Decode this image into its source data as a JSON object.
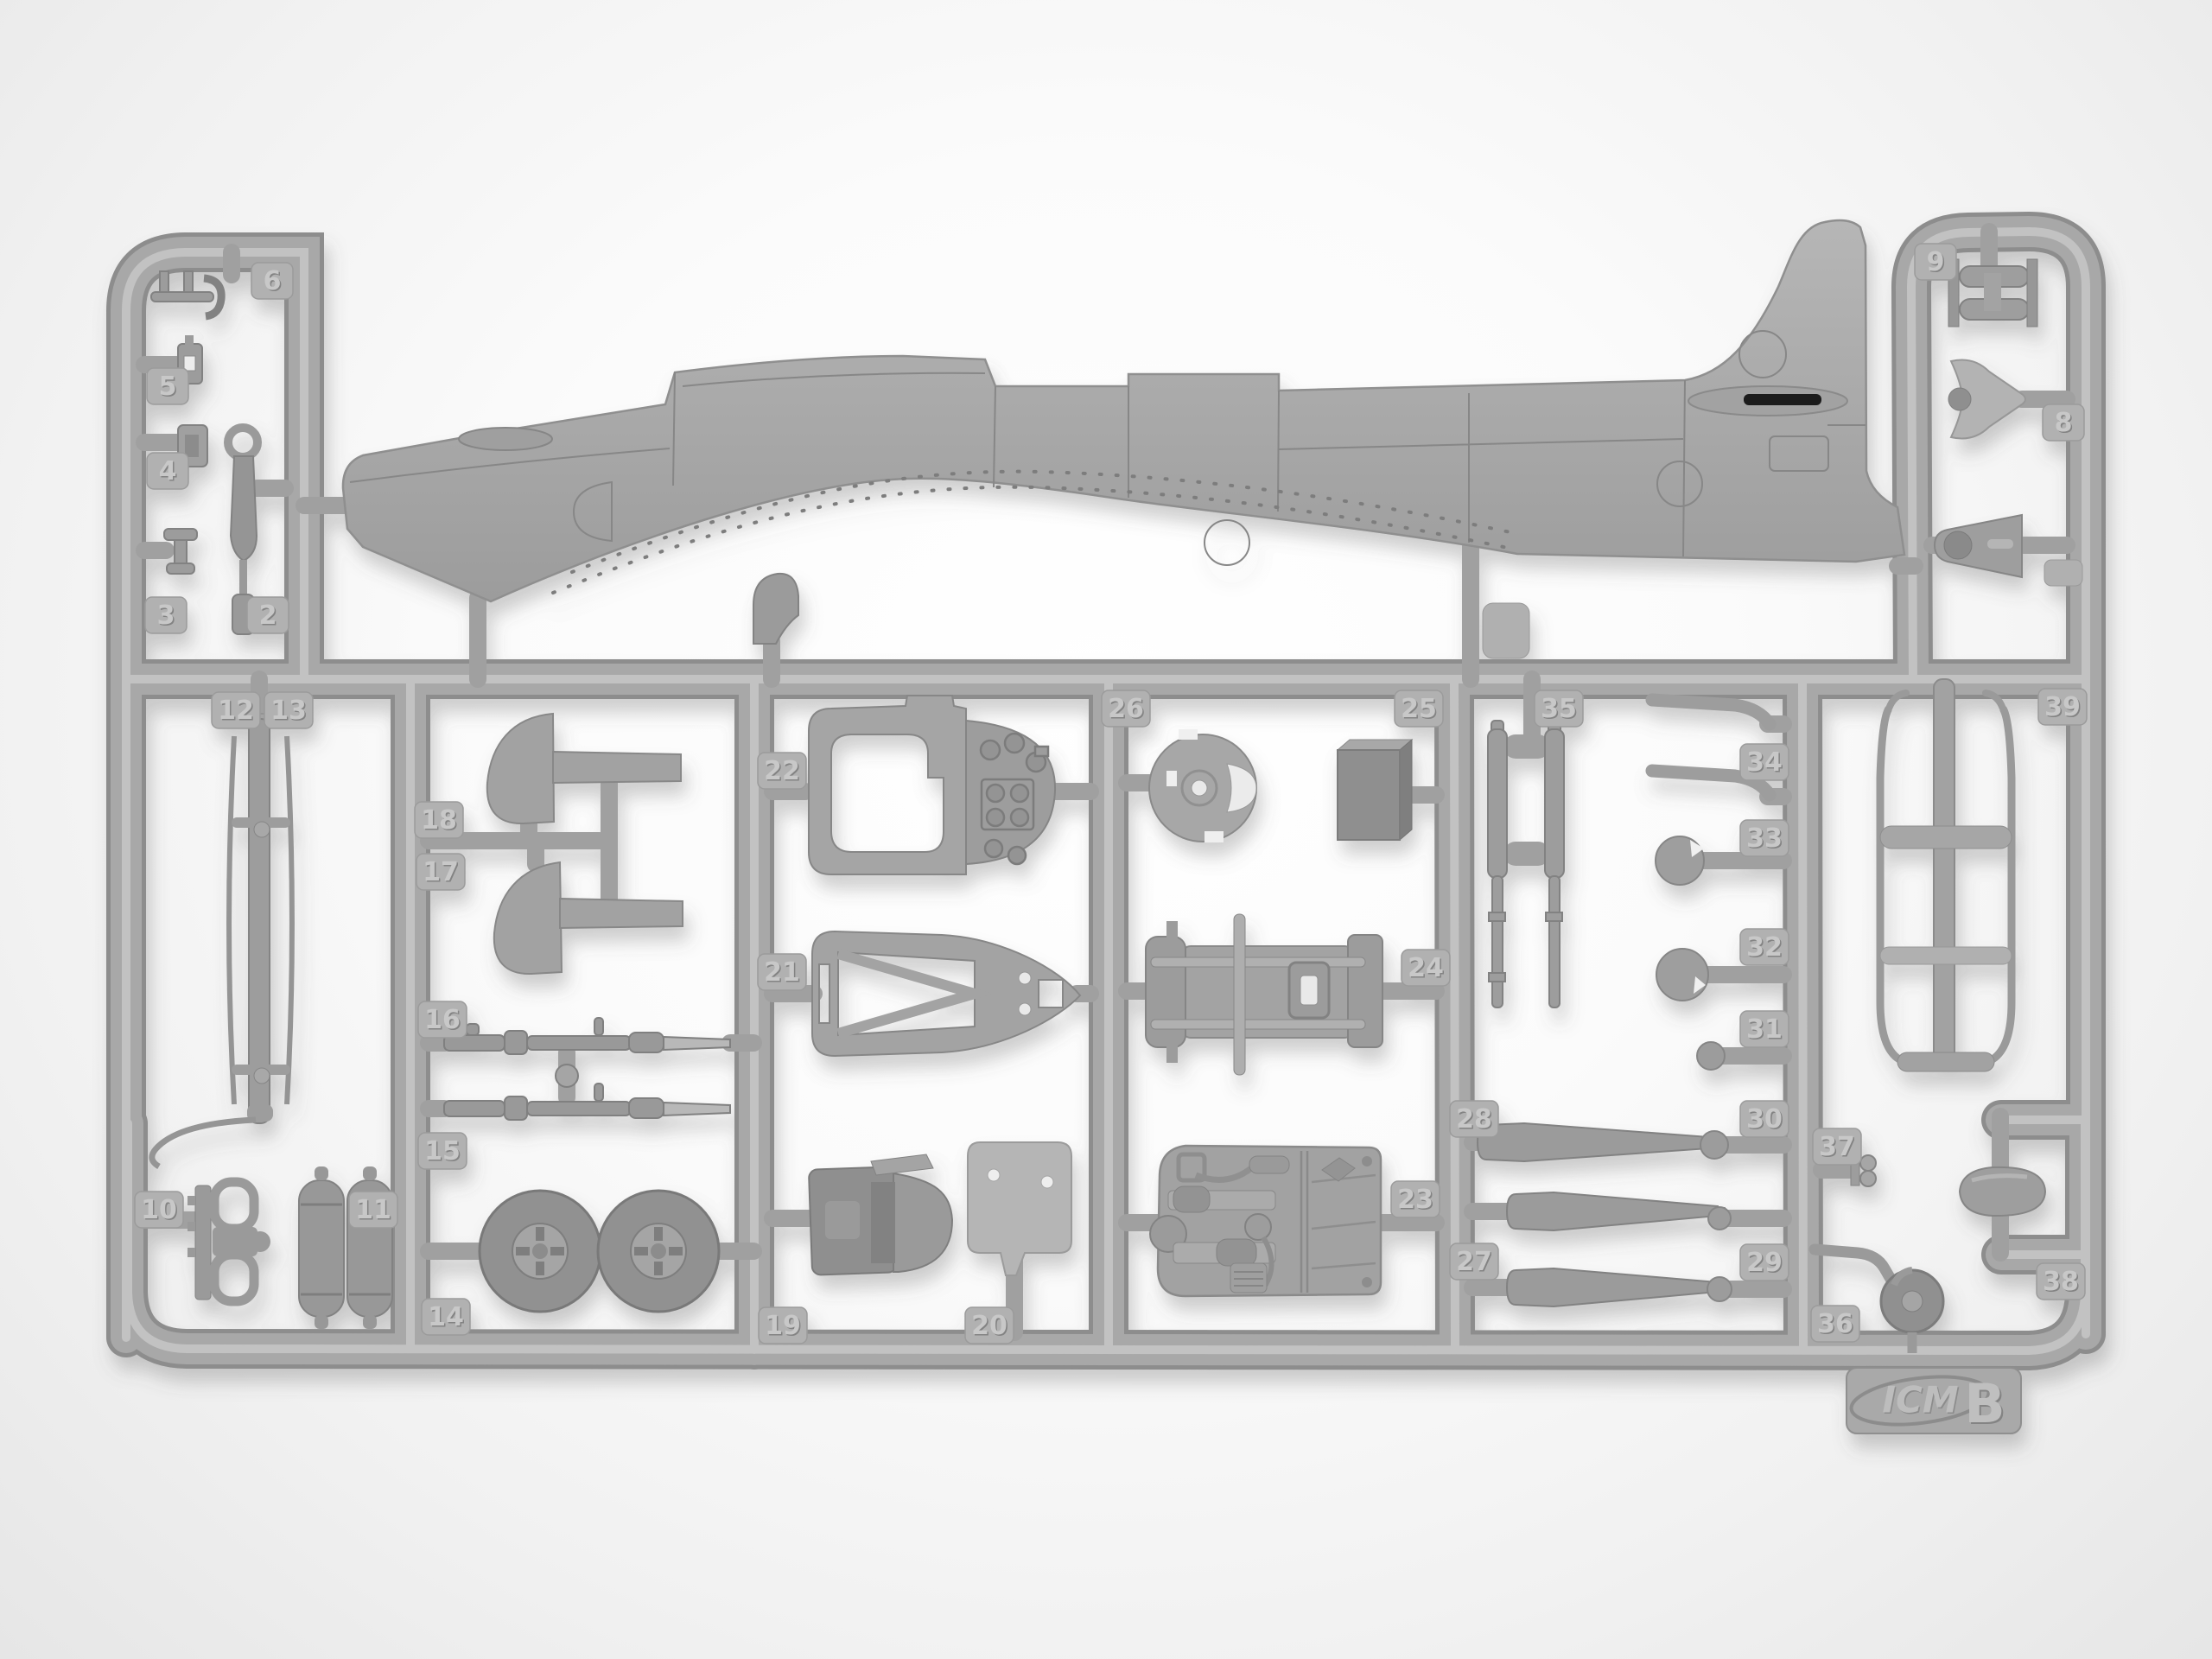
{
  "sprue": {
    "brand": "ICM",
    "letter": "B",
    "tags": {
      "t2": "2",
      "t3": "3",
      "t4": "4",
      "t5": "5",
      "t6": "6",
      "t8": "8",
      "t9": "9",
      "t10": "10",
      "t11": "11",
      "t12": "12",
      "t13": "13",
      "t14": "14",
      "t15": "15",
      "t16": "16",
      "t17": "17",
      "t18": "18",
      "t19": "19",
      "t20": "20",
      "t21": "21",
      "t22": "22",
      "t23": "23",
      "t24": "24",
      "t25": "25",
      "t26": "26",
      "t27": "27",
      "t28": "28",
      "t29": "29",
      "t30": "30",
      "t31": "31",
      "t32": "32",
      "t33": "33",
      "t34": "34",
      "t35": "35",
      "t36": "36",
      "t37": "37",
      "t38": "38",
      "t39": "39"
    }
  }
}
